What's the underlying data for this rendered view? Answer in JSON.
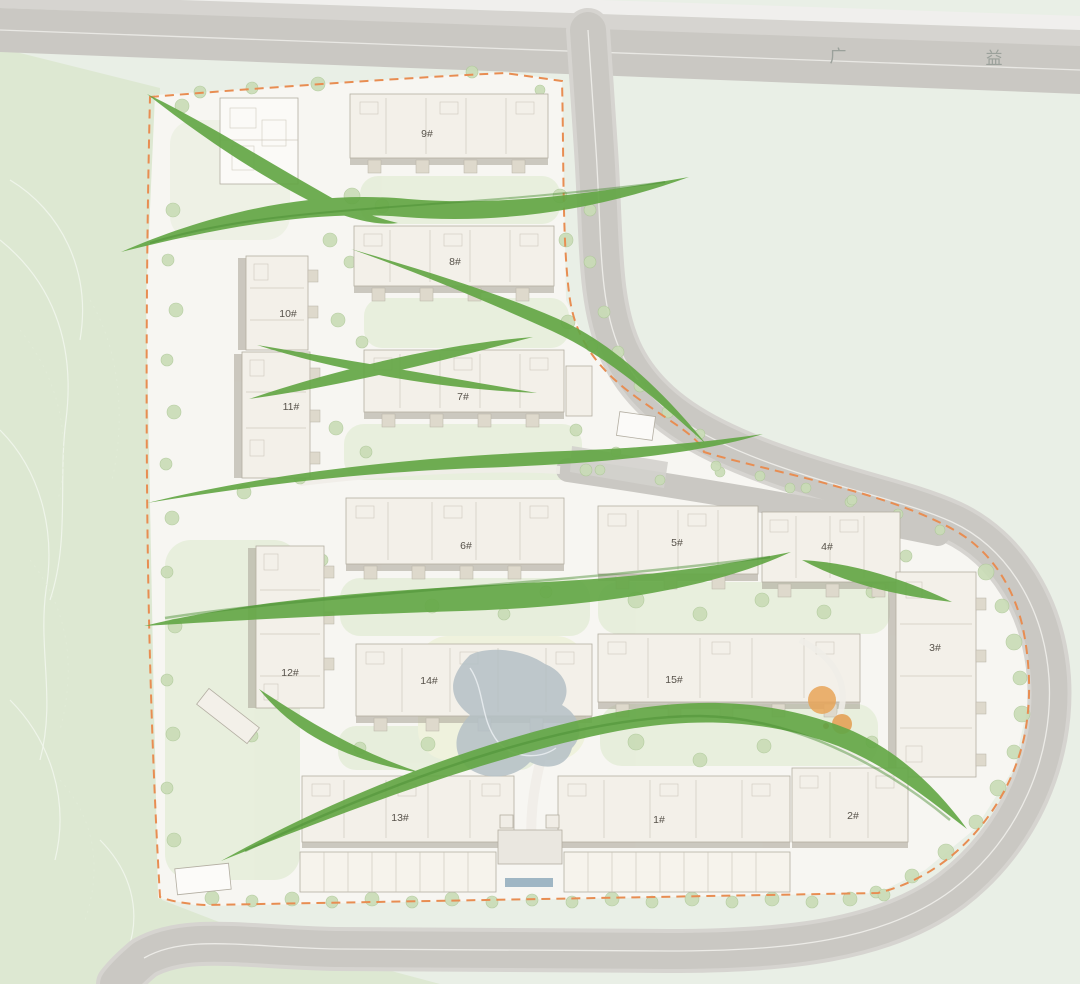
{
  "page": {
    "type": "residential-site-master-plan"
  },
  "road_name": {
    "left_char": "广",
    "right_char": "益"
  },
  "buildings": [
    {
      "id": "9",
      "label": "9#"
    },
    {
      "id": "8",
      "label": "8#"
    },
    {
      "id": "7",
      "label": "7#"
    },
    {
      "id": "10",
      "label": "10#"
    },
    {
      "id": "11",
      "label": "11#"
    },
    {
      "id": "6",
      "label": "6#"
    },
    {
      "id": "5",
      "label": "5#"
    },
    {
      "id": "4",
      "label": "4#"
    },
    {
      "id": "12",
      "label": "12#"
    },
    {
      "id": "14",
      "label": "14#"
    },
    {
      "id": "15",
      "label": "15#"
    },
    {
      "id": "3",
      "label": "3#"
    },
    {
      "id": "13",
      "label": "13#"
    },
    {
      "id": "1",
      "label": "1#"
    },
    {
      "id": "2",
      "label": "2#"
    }
  ],
  "colors": {
    "corridor_green": "#64a746",
    "corridor_green_dark": "#478c31",
    "boundary_orange": "#e88d52",
    "road_gray": "#cac8c3",
    "road_gray_light": "#d6d4d0",
    "water_gray": "#b4bfc6",
    "hillside_green": "#dde8d2",
    "field_mint": "#e9efe6",
    "parcel_white": "#f7f6f2",
    "building_fill": "#f3f0e9",
    "building_shadow": "#a8a295",
    "tree_green": "#c9dcb6",
    "lawn_green": "#e4edd7",
    "play_orange": "#e7a558"
  }
}
